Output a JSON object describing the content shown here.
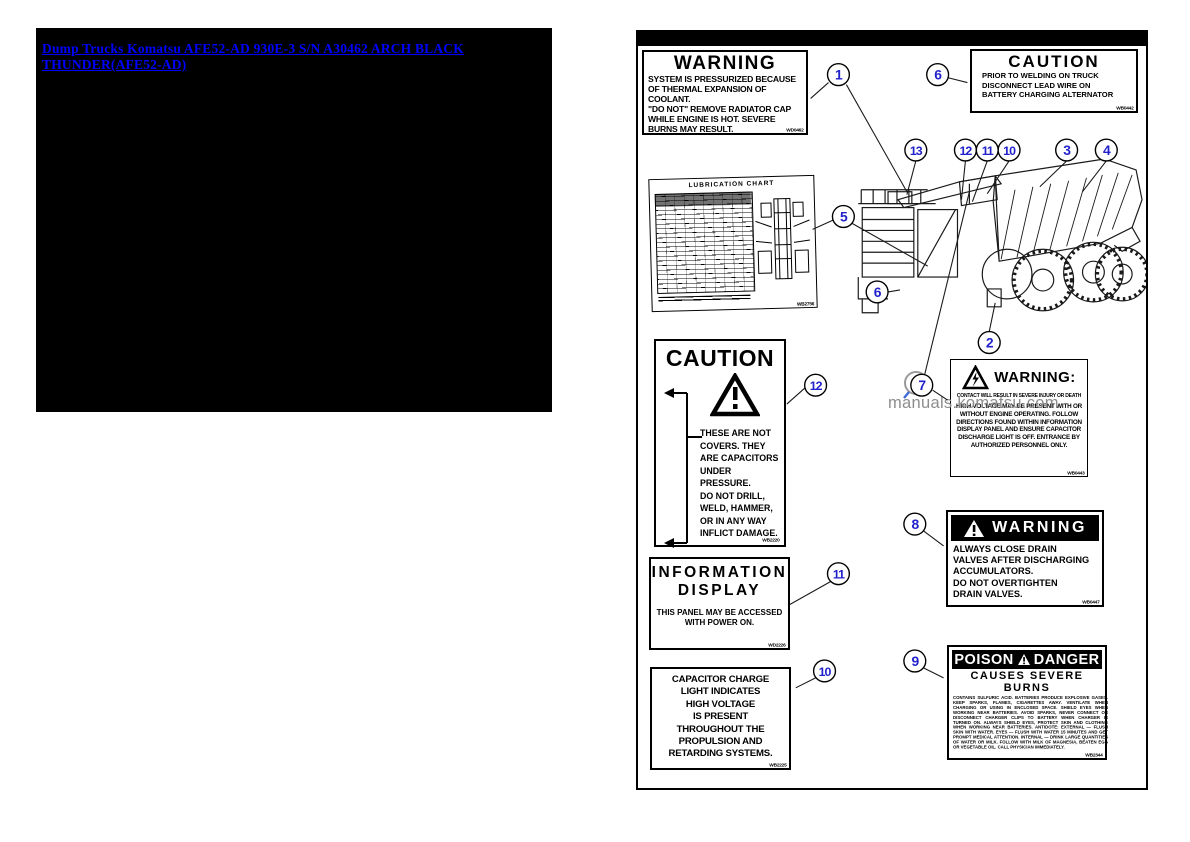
{
  "nav": {
    "title_link": {
      "text": "Dump Trucks Komatsu AFE52-AD 930E-3 S/N A30462 ARCH BLACK THUNDER(AFE52-AD)",
      "color": "#0000ff",
      "bg": "#000000"
    }
  },
  "watermark": {
    "text": "manuals.komatsu.com",
    "color": "#8d8d8d"
  },
  "figure": {
    "callout_color": "#2222cc",
    "callouts": [
      {
        "n": "1",
        "x": 202,
        "y": 42
      },
      {
        "n": "6",
        "x": 302,
        "y": 42
      },
      {
        "n": "13",
        "x": 280,
        "y": 118
      },
      {
        "n": "12",
        "x": 330,
        "y": 118
      },
      {
        "n": "11",
        "x": 352,
        "y": 118
      },
      {
        "n": "10",
        "x": 374,
        "y": 118
      },
      {
        "n": "3",
        "x": 432,
        "y": 118
      },
      {
        "n": "4",
        "x": 472,
        "y": 118
      },
      {
        "n": "5",
        "x": 207,
        "y": 185
      },
      {
        "n": "6",
        "x": 241,
        "y": 261
      },
      {
        "n": "2",
        "x": 354,
        "y": 312
      },
      {
        "n": "12",
        "x": 179,
        "y": 355
      },
      {
        "n": "7",
        "x": 286,
        "y": 355
      },
      {
        "n": "8",
        "x": 279,
        "y": 495
      },
      {
        "n": "11",
        "x": 202,
        "y": 545
      },
      {
        "n": "9",
        "x": 279,
        "y": 633
      },
      {
        "n": "10",
        "x": 188,
        "y": 643
      }
    ]
  },
  "labels": {
    "radiator_warning": {
      "title": "WARNING",
      "body": [
        "SYSTEM IS PRESSURIZED BECAUSE",
        "OF THERMAL EXPANSION OF COOLANT.",
        "\"DO NOT\" REMOVE RADIATOR CAP",
        "WHILE ENGINE IS HOT. SEVERE",
        "BURNS MAY RESULT."
      ],
      "code": "WD0462"
    },
    "welding_caution": {
      "title": "CAUTION",
      "body": [
        "PRIOR TO WELDING ON TRUCK",
        "DISCONNECT LEAD WIRE ON",
        "BATTERY CHARGING ALTERNATOR"
      ],
      "code": "WB0442"
    },
    "lubrication_chart": {
      "title": "LUBRICATION  CHART",
      "code": "WB2756"
    },
    "capacitor_caution": {
      "title": "CAUTION",
      "body": [
        "THESE ARE NOT",
        "COVERS. THEY",
        "ARE CAPACITORS",
        "UNDER PRESSURE.",
        "DO NOT DRILL,",
        "WELD, HAMMER,",
        "OR IN ANY WAY",
        "INFLICT DAMAGE."
      ],
      "code": "WB2220"
    },
    "information_display": {
      "title": [
        "INFORMATION",
        "DISPLAY"
      ],
      "body": [
        "THIS PANEL MAY BE ACCESSED",
        "WITH POWER ON."
      ],
      "code": "WD2226"
    },
    "capacitor_charge": {
      "body": [
        "CAPACITOR CHARGE",
        "LIGHT INDICATES",
        "HIGH VOLTAGE",
        "IS PRESENT",
        "THROUGHOUT THE",
        "PROPULSION AND",
        "RETARDING SYSTEMS."
      ],
      "code": "WB2225"
    },
    "high_voltage_warning": {
      "title": "WARNING:",
      "subtitle": "CONTACT WILL RESULT IN SEVERE INJURY OR DEATH",
      "body": [
        "HIGH VOLTAGE MAY BE PRESENT WITH OR",
        "WITHOUT ENGINE OPERATING. FOLLOW",
        "DIRECTIONS FOUND WITHIN INFORMATION",
        "DISPLAY PANEL AND ENSURE CAPACITOR",
        "DISCHARGE LIGHT IS OFF. ENTRANCE BY",
        "AUTHORIZED PERSONNEL ONLY."
      ],
      "code": "WB0443"
    },
    "drain_valve_warning": {
      "title": "WARNING",
      "body": [
        "ALWAYS CLOSE DRAIN",
        "VALVES AFTER DISCHARGING",
        "ACCUMULATORS.",
        "DO NOT OVERTIGHTEN",
        "DRAIN VALVES."
      ],
      "code": "WB0447"
    },
    "poison_danger": {
      "title_left": "POISON",
      "title_right": "DANGER",
      "subtitle": "CAUSES SEVERE BURNS",
      "body": "CONTAINS SULFURIC ACID. BATTERIES PRODUCE EXPLOSIVE GASES. KEEP SPARKS, FLAMES, CIGARETTES AWAY. VENTILATE WHEN CHARGING OR USING IN ENCLOSED SPACE. SHIELD EYES WHEN WORKING NEAR BATTERIES. AVOID SPARKS, NEVER CONNECT OR DISCONNECT CHARGER CLIPS TO BATTERY WHEN CHARGER IS TURNED ON. ALWAYS SHIELD EYES, PROTECT SKIN AND CLOTHING WHEN WORKING NEAR BATTERIES. ANTIDOTE: EXTERNAL — FLUSH SKIN WITH WATER. EYES — FLUSH WITH WATER 15 MINUTES AND GET PROMPT MEDICAL ATTENTION. INTERNAL — DRINK LARGE QUANTITIES OF WATER OR MILK. FOLLOW WITH MILK OF MAGNESIA, BEATEN EGG OR VEGETABLE OIL. CALL PHYSICIAN IMMEDIATELY.",
      "code": "WB2344"
    }
  }
}
